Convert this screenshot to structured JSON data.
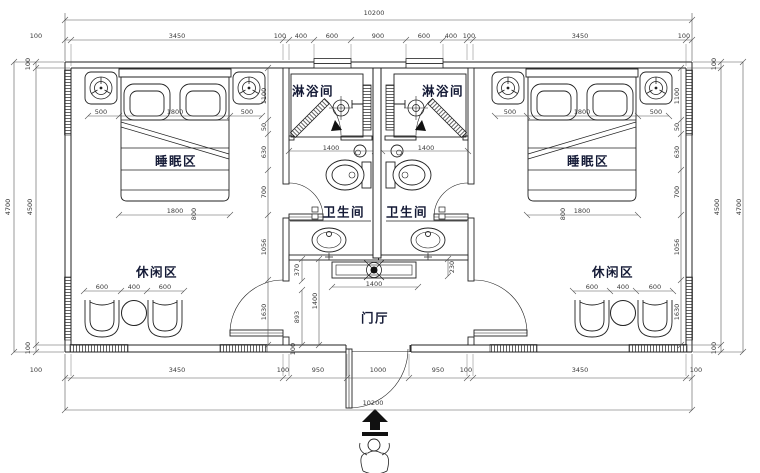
{
  "canvas": {
    "width": 760,
    "height": 473,
    "background": "#ffffff",
    "line_color": "#222222",
    "dim_color": "#3a3a3a",
    "label_color": "#141a36"
  },
  "room_labels": [
    {
      "t": "淋浴间",
      "x": 313,
      "y": 90
    },
    {
      "t": "淋浴间",
      "x": 443,
      "y": 90
    },
    {
      "t": "睡眠区",
      "x": 176,
      "y": 160
    },
    {
      "t": "睡眠区",
      "x": 588,
      "y": 160
    },
    {
      "t": "卫生间",
      "x": 344,
      "y": 211
    },
    {
      "t": "卫生间",
      "x": 407,
      "y": 211
    },
    {
      "t": "休闲区",
      "x": 157,
      "y": 271
    },
    {
      "t": "休闲区",
      "x": 613,
      "y": 271
    },
    {
      "t": "门厅",
      "x": 375,
      "y": 317
    }
  ],
  "dim_labels": [
    {
      "t": "10200",
      "x": 374,
      "y": 13
    },
    {
      "t": "100",
      "x": 36,
      "y": 36
    },
    {
      "t": "3450",
      "x": 177,
      "y": 36
    },
    {
      "t": "100",
      "x": 280,
      "y": 36
    },
    {
      "t": "400",
      "x": 301,
      "y": 36
    },
    {
      "t": "600",
      "x": 332,
      "y": 36
    },
    {
      "t": "900",
      "x": 378,
      "y": 36
    },
    {
      "t": "600",
      "x": 424,
      "y": 36
    },
    {
      "t": "400",
      "x": 451,
      "y": 36
    },
    {
      "t": "100",
      "x": 469,
      "y": 36
    },
    {
      "t": "3450",
      "x": 580,
      "y": 36
    },
    {
      "t": "100",
      "x": 684,
      "y": 36
    },
    {
      "t": "100",
      "x": 36,
      "y": 370
    },
    {
      "t": "3450",
      "x": 177,
      "y": 370
    },
    {
      "t": "100",
      "x": 283,
      "y": 370
    },
    {
      "t": "950",
      "x": 318,
      "y": 370
    },
    {
      "t": "1000",
      "x": 378,
      "y": 370
    },
    {
      "t": "950",
      "x": 438,
      "y": 370
    },
    {
      "t": "100",
      "x": 466,
      "y": 370
    },
    {
      "t": "3450",
      "x": 580,
      "y": 370
    },
    {
      "t": "100",
      "x": 696,
      "y": 370
    },
    {
      "t": "10200",
      "x": 373,
      "y": 403
    },
    {
      "t": "4700",
      "x": 8,
      "y": 207,
      "r": -90
    },
    {
      "t": "4500",
      "x": 30,
      "y": 207,
      "r": -90
    },
    {
      "t": "100",
      "x": 28,
      "y": 64,
      "r": -90
    },
    {
      "t": "100",
      "x": 28,
      "y": 348,
      "r": -90
    },
    {
      "t": "4500",
      "x": 717,
      "y": 207,
      "r": -90
    },
    {
      "t": "4700",
      "x": 739,
      "y": 207,
      "r": -90
    },
    {
      "t": "100",
      "x": 714,
      "y": 64,
      "r": -90
    },
    {
      "t": "100",
      "x": 714,
      "y": 348,
      "r": -90
    },
    {
      "t": "500",
      "x": 101,
      "y": 112
    },
    {
      "t": "1800",
      "x": 175,
      "y": 112
    },
    {
      "t": "500",
      "x": 247,
      "y": 112
    },
    {
      "t": "1800",
      "x": 175,
      "y": 211
    },
    {
      "t": "800",
      "x": 194,
      "y": 214,
      "r": -90
    },
    {
      "t": "600",
      "x": 102,
      "y": 287
    },
    {
      "t": "400",
      "x": 134,
      "y": 287
    },
    {
      "t": "600",
      "x": 165,
      "y": 287
    },
    {
      "t": "1100",
      "x": 264,
      "y": 96,
      "r": -90
    },
    {
      "t": "50",
      "x": 264,
      "y": 127,
      "r": -90
    },
    {
      "t": "630",
      "x": 264,
      "y": 152,
      "r": -90
    },
    {
      "t": "700",
      "x": 264,
      "y": 192,
      "r": -90
    },
    {
      "t": "1056",
      "x": 264,
      "y": 247,
      "r": -90
    },
    {
      "t": "1630",
      "x": 264,
      "y": 312,
      "r": -90
    },
    {
      "t": "500",
      "x": 510,
      "y": 112
    },
    {
      "t": "1800",
      "x": 582,
      "y": 112
    },
    {
      "t": "500",
      "x": 656,
      "y": 112
    },
    {
      "t": "1800",
      "x": 582,
      "y": 211
    },
    {
      "t": "800",
      "x": 563,
      "y": 214,
      "r": -90
    },
    {
      "t": "600",
      "x": 592,
      "y": 287
    },
    {
      "t": "400",
      "x": 623,
      "y": 287
    },
    {
      "t": "600",
      "x": 655,
      "y": 287
    },
    {
      "t": "1100",
      "x": 677,
      "y": 96,
      "r": -90
    },
    {
      "t": "50",
      "x": 677,
      "y": 127,
      "r": -90
    },
    {
      "t": "630",
      "x": 677,
      "y": 152,
      "r": -90
    },
    {
      "t": "700",
      "x": 677,
      "y": 192,
      "r": -90
    },
    {
      "t": "1056",
      "x": 677,
      "y": 247,
      "r": -90
    },
    {
      "t": "1630",
      "x": 677,
      "y": 312,
      "r": -90
    },
    {
      "t": "1400",
      "x": 331,
      "y": 148
    },
    {
      "t": "1400",
      "x": 426,
      "y": 148
    },
    {
      "t": "370",
      "x": 297,
      "y": 270,
      "r": -90
    },
    {
      "t": "230",
      "x": 452,
      "y": 267,
      "r": -90
    },
    {
      "t": "1400",
      "x": 374,
      "y": 284
    },
    {
      "t": "1400",
      "x": 315,
      "y": 301,
      "r": -90
    },
    {
      "t": "893",
      "x": 297,
      "y": 317,
      "r": -90
    },
    {
      "t": "100",
      "x": 293,
      "y": 349,
      "r": -90
    }
  ]
}
